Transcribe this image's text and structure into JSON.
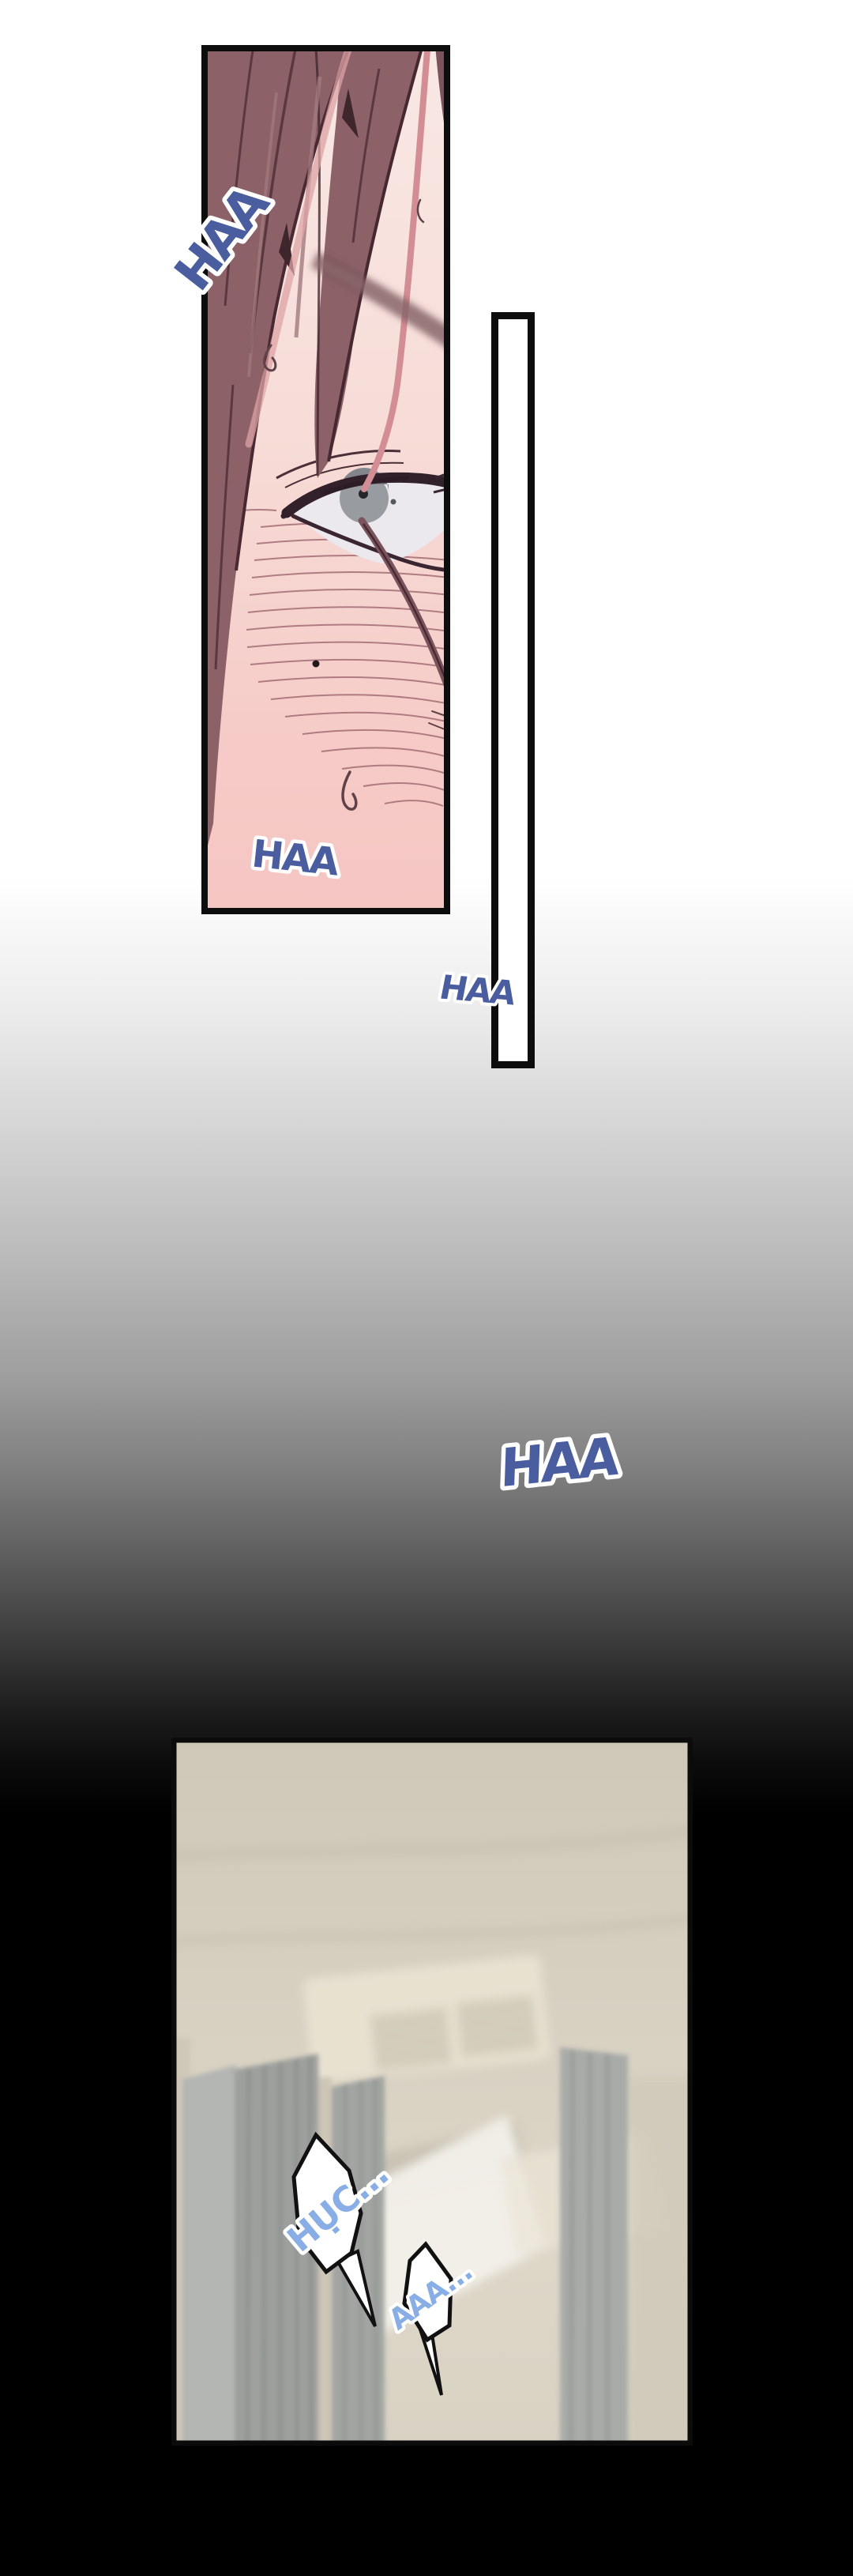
{
  "comic": {
    "sfx": {
      "haa_top": "HAA",
      "haa_panel_bottom": "HAA",
      "haa_beside_divider": "HAA",
      "haa_dark_area": "HAA"
    },
    "speech": {
      "gasp": "HỤC...",
      "moan": "AAA..."
    }
  },
  "colors": {
    "sfx_blue": "#4a5d9e",
    "speech_blue": "#88aee5",
    "outline_white": "#ffffff",
    "panel_border": "#0d0d0d",
    "skin_top": "#f8e8e4",
    "skin_bottom": "#f5c5c2",
    "hair_base": "#8d6168",
    "hair_dark": "#4a2a32",
    "iris_gray": "#989ca0",
    "room_beige": "#d8d1c2",
    "curtain_gray": "#9da09d"
  }
}
